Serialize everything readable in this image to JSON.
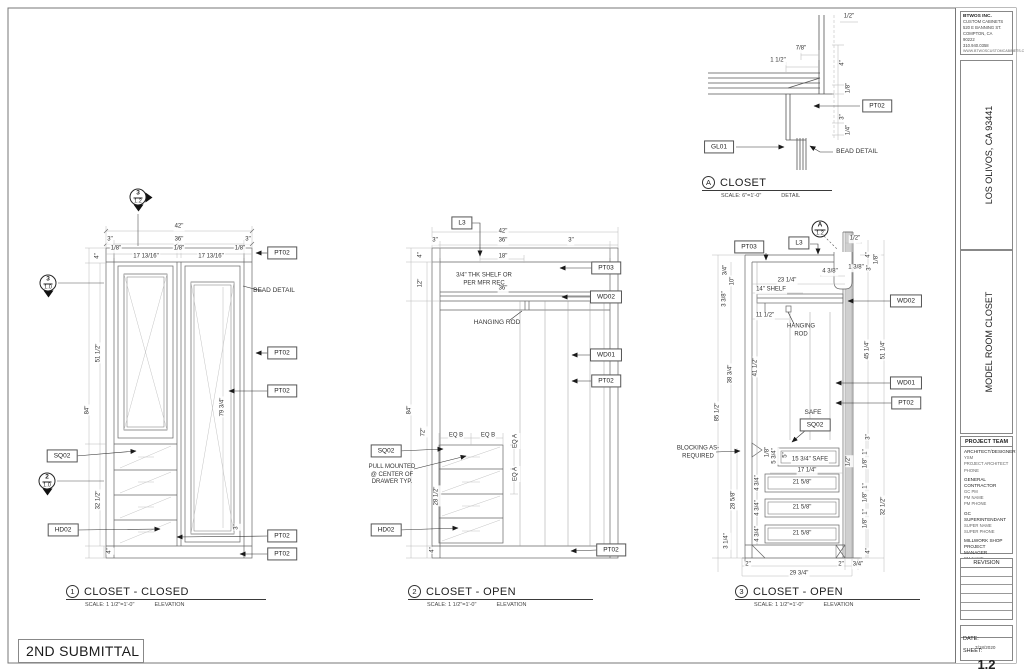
{
  "sheet": {
    "submittal": "2ND SUBMITTAL",
    "company": {
      "name": "BTWOS INC.",
      "lines": [
        "CUSTOM CABINETS",
        "520 E BANNING ST.",
        "COMPTON, CA",
        "90222",
        "310.940.0358",
        "WWW.BTWOSCUSTOMCABINETS.COM"
      ]
    },
    "project_location": {
      "label": "PROJECT LOCATION",
      "value": "LOS OLIVOS, CA 93441"
    },
    "room_or_area": {
      "label": "ROOM OR AREA",
      "value": "MODEL ROOM CLOSET"
    },
    "project_team": {
      "header": "PROJECT TEAM",
      "groups": [
        {
          "title": "ARCHITECT/DESIGNER",
          "lines": [
            "YSM",
            "PROJECT ARCHITECT",
            "PHONE"
          ]
        },
        {
          "title": "GENERAL CONTRACTOR",
          "lines": [
            "GC PM",
            "PM NAME",
            "PM PHONE"
          ]
        },
        {
          "title": "GC SUPERINTENDANT",
          "lines": [
            "SUPER NAME",
            "SUPER PHONE"
          ]
        },
        {
          "title": "MILLWORK SHOP PROJECT MANAGER",
          "lines": [
            "PM NAME",
            "PM PHONE"
          ]
        }
      ]
    },
    "revision": {
      "header": "REVISION"
    },
    "date": {
      "label": "DATE:",
      "value": "7/18/2020"
    },
    "sheet_number": {
      "label": "SHEET:",
      "value": "1.2"
    }
  },
  "viewport_titles": [
    {
      "num": "1",
      "title": "CLOSET - CLOSED",
      "scale": "SCALE: 1 1/2\"=1'-0\"",
      "type": "ELEVATION",
      "x": 66,
      "y": 585,
      "w": 200
    },
    {
      "num": "2",
      "title": "CLOSET - OPEN",
      "scale": "SCALE: 1 1/2\"=1'-0\"",
      "type": "ELEVATION",
      "x": 408,
      "y": 585,
      "w": 185
    },
    {
      "num": "3",
      "title": "CLOSET - OPEN",
      "scale": "SCALE: 1 1/2\"=1'-0\"",
      "type": "ELEVATION",
      "x": 735,
      "y": 585,
      "w": 185
    },
    {
      "num": "A",
      "title": "CLOSET",
      "scale": "SCALE: 6\"=1'-0\"",
      "type": "DETAIL",
      "x": 702,
      "y": 176,
      "w": 130
    }
  ],
  "section_markers": [
    {
      "top": "3",
      "bottom": "1.2",
      "x": 138,
      "y": 197,
      "tri": "down-right"
    },
    {
      "top": "3",
      "bottom": "1.0",
      "x": 48,
      "y": 283,
      "tri": "down"
    },
    {
      "top": "2",
      "bottom": "1.0",
      "x": 47,
      "y": 481,
      "tri": "down"
    },
    {
      "top": "A",
      "bottom": "1.2",
      "x": 820,
      "y": 229,
      "tri": "none"
    }
  ],
  "annotations": [
    {
      "t": "1/2\"",
      "x": 849,
      "y": 17
    },
    {
      "t": "7/8\"",
      "x": 801,
      "y": 49
    },
    {
      "t": "1 1/2\"",
      "x": 778,
      "y": 61
    },
    {
      "t": "4\"",
      "x": 843,
      "y": 63,
      "r": -90
    },
    {
      "t": "1/8\"",
      "x": 849,
      "y": 88,
      "r": -90
    },
    {
      "t": "PT02",
      "x": 877,
      "y": 106,
      "k": "tag",
      "n": "tag-pt02"
    },
    {
      "t": "3\"",
      "x": 843,
      "y": 117,
      "r": -90
    },
    {
      "t": "1/4\"",
      "x": 849,
      "y": 130,
      "r": -90
    },
    {
      "t": "GL01",
      "x": 719,
      "y": 147,
      "k": "tag",
      "n": "tag-gl01"
    },
    {
      "t": "BEAD DETAIL",
      "x": 857,
      "y": 152,
      "k": "label",
      "n": "bead-detail-label"
    },
    {
      "t": "42\"",
      "x": 179,
      "y": 227
    },
    {
      "t": "3\"",
      "x": 110,
      "y": 240
    },
    {
      "t": "36\"",
      "x": 179,
      "y": 240
    },
    {
      "t": "3\"",
      "x": 248,
      "y": 240
    },
    {
      "t": "1/8\"",
      "x": 116,
      "y": 249
    },
    {
      "t": "17 13/16\"",
      "x": 146,
      "y": 257
    },
    {
      "t": "1/8\"",
      "x": 179,
      "y": 249
    },
    {
      "t": "17 13/16\"",
      "x": 211,
      "y": 257
    },
    {
      "t": "1/8\"",
      "x": 240,
      "y": 249
    },
    {
      "t": "4\"",
      "x": 98,
      "y": 256,
      "r": -90
    },
    {
      "t": "PT02",
      "x": 282,
      "y": 253,
      "k": "tag",
      "n": "tag-pt02"
    },
    {
      "t": "BEAD DETAIL",
      "x": 274,
      "y": 291,
      "k": "label",
      "n": "bead-detail-label"
    },
    {
      "t": "51 1/2\"",
      "x": 99,
      "y": 353,
      "r": -90
    },
    {
      "t": "84\"",
      "x": 88,
      "y": 410,
      "r": -90
    },
    {
      "t": "PT02",
      "x": 282,
      "y": 353,
      "k": "tag",
      "n": "tag-pt02"
    },
    {
      "t": "PT02",
      "x": 282,
      "y": 391,
      "k": "tag",
      "n": "tag-pt02"
    },
    {
      "t": "79 3/4\"",
      "x": 223,
      "y": 407,
      "r": -90
    },
    {
      "t": "SQ02",
      "x": 62,
      "y": 456,
      "k": "tag",
      "n": "tag-sq02"
    },
    {
      "t": "32 1/2\"",
      "x": 99,
      "y": 500,
      "r": -90
    },
    {
      "t": "HD02",
      "x": 63,
      "y": 530,
      "k": "tag",
      "n": "tag-hd02"
    },
    {
      "t": "3\"",
      "x": 237,
      "y": 527,
      "r": -90
    },
    {
      "t": "PT02",
      "x": 282,
      "y": 536,
      "k": "tag",
      "n": "tag-pt02"
    },
    {
      "t": "4\"",
      "x": 110,
      "y": 551,
      "r": -90
    },
    {
      "t": "PT02",
      "x": 282,
      "y": 554,
      "k": "tag",
      "n": "tag-pt02"
    },
    {
      "t": "L3",
      "x": 462,
      "y": 223,
      "k": "tag",
      "n": "tag-l3"
    },
    {
      "t": "42\"",
      "x": 503,
      "y": 232
    },
    {
      "t": "3\"",
      "x": 435,
      "y": 241
    },
    {
      "t": "36\"",
      "x": 503,
      "y": 241
    },
    {
      "t": "3\"",
      "x": 571,
      "y": 241
    },
    {
      "t": "4\"",
      "x": 421,
      "y": 255,
      "r": -90
    },
    {
      "t": "18\"",
      "x": 503,
      "y": 257
    },
    {
      "t": "3/4\" THK SHELF OR\nPER MFR REC",
      "x": 484,
      "y": 280,
      "k": "note",
      "n": "shelf-note"
    },
    {
      "t": "PT03",
      "x": 606,
      "y": 268,
      "k": "tag",
      "n": "tag-pt03"
    },
    {
      "t": "36\"",
      "x": 503,
      "y": 289
    },
    {
      "t": "WD02",
      "x": 606,
      "y": 297,
      "k": "tag",
      "n": "tag-wd02"
    },
    {
      "t": "12\"",
      "x": 421,
      "y": 283,
      "r": -90
    },
    {
      "t": "HANGING ROD",
      "x": 497,
      "y": 323,
      "k": "label",
      "n": "hanging-rod-label"
    },
    {
      "t": "WD01",
      "x": 606,
      "y": 355,
      "k": "tag",
      "n": "tag-wd01"
    },
    {
      "t": "PT02",
      "x": 606,
      "y": 381,
      "k": "tag",
      "n": "tag-pt02"
    },
    {
      "t": "84\"",
      "x": 410,
      "y": 410,
      "r": -90
    },
    {
      "t": "72\"",
      "x": 424,
      "y": 432,
      "r": -90
    },
    {
      "t": "EQ B",
      "x": 456,
      "y": 436
    },
    {
      "t": "EQ B",
      "x": 488,
      "y": 436
    },
    {
      "t": "EQ A",
      "x": 516,
      "y": 441,
      "r": -90
    },
    {
      "t": "EQ A",
      "x": 516,
      "y": 474,
      "r": -90
    },
    {
      "t": "SQ02",
      "x": 386,
      "y": 451,
      "k": "tag",
      "n": "tag-sq02"
    },
    {
      "t": "PULL MOUNTED\n@ CENTER OF\nDRAWER TYP.",
      "x": 392,
      "y": 475,
      "k": "note",
      "n": "pull-note"
    },
    {
      "t": "28 1/2\"",
      "x": 437,
      "y": 496,
      "r": -90
    },
    {
      "t": "HD02",
      "x": 386,
      "y": 530,
      "k": "tag",
      "n": "tag-hd02"
    },
    {
      "t": "4\"",
      "x": 433,
      "y": 550,
      "r": -90
    },
    {
      "t": "PT02",
      "x": 611,
      "y": 550,
      "k": "tag",
      "n": "tag-pt02"
    },
    {
      "t": "PT03",
      "x": 749,
      "y": 247,
      "k": "tag",
      "n": "tag-pt03"
    },
    {
      "t": "L3",
      "x": 799,
      "y": 243,
      "k": "tag",
      "n": "tag-l3"
    },
    {
      "t": "1/2\"",
      "x": 855,
      "y": 239
    },
    {
      "t": "4\"",
      "x": 869,
      "y": 255,
      "r": -90
    },
    {
      "t": "1/8\"",
      "x": 877,
      "y": 259,
      "r": -90
    },
    {
      "t": "4 3/8\"",
      "x": 830,
      "y": 272
    },
    {
      "t": "1 3/8\"",
      "x": 856,
      "y": 268
    },
    {
      "t": "3\"",
      "x": 870,
      "y": 268,
      "r": -90
    },
    {
      "t": "3/4\"",
      "x": 726,
      "y": 270,
      "r": -90
    },
    {
      "t": "10\"",
      "x": 733,
      "y": 281,
      "r": -90
    },
    {
      "t": "23 1/4\"",
      "x": 787,
      "y": 281
    },
    {
      "t": "14\" SHELF",
      "x": 771,
      "y": 290
    },
    {
      "t": "3 3/8\"",
      "x": 725,
      "y": 299,
      "r": -90
    },
    {
      "t": "WD02",
      "x": 906,
      "y": 301,
      "k": "tag",
      "n": "tag-wd02"
    },
    {
      "t": "11 1/2\"",
      "x": 765,
      "y": 316
    },
    {
      "t": "HANGING\nROD",
      "x": 801,
      "y": 331,
      "k": "note",
      "n": "hanging-rod-label"
    },
    {
      "t": "45 1/4\"",
      "x": 868,
      "y": 350,
      "r": -90
    },
    {
      "t": "51 1/4\"",
      "x": 884,
      "y": 350,
      "r": -90
    },
    {
      "t": "41 1/2\"",
      "x": 756,
      "y": 367,
      "r": -90
    },
    {
      "t": "38 3/4\"",
      "x": 731,
      "y": 374,
      "r": -90
    },
    {
      "t": "WD01",
      "x": 906,
      "y": 383,
      "k": "tag",
      "n": "tag-wd01"
    },
    {
      "t": "PT02",
      "x": 906,
      "y": 403,
      "k": "tag",
      "n": "tag-pt02"
    },
    {
      "t": "85 1/2\"",
      "x": 718,
      "y": 412,
      "r": -90
    },
    {
      "t": "SAFE",
      "x": 813,
      "y": 413,
      "k": "label",
      "n": "safe-label"
    },
    {
      "t": "SQ02",
      "x": 815,
      "y": 425,
      "k": "tag",
      "n": "tag-sq02"
    },
    {
      "t": "BLOCKING AS-\nREQUIRED",
      "x": 698,
      "y": 453,
      "k": "note",
      "n": "blocking-note"
    },
    {
      "t": "1/8\"",
      "x": 768,
      "y": 452,
      "r": -90
    },
    {
      "t": "5 3/4\"",
      "x": 775,
      "y": 456,
      "r": -90
    },
    {
      "t": "5\"",
      "x": 786,
      "y": 455,
      "r": -90
    },
    {
      "t": "15 3/4\" SAFE",
      "x": 810,
      "y": 460
    },
    {
      "t": "1/2\"",
      "x": 849,
      "y": 461,
      "r": -90
    },
    {
      "t": "3\"",
      "x": 869,
      "y": 437,
      "r": -90
    },
    {
      "t": "17 1/4\"",
      "x": 807,
      "y": 471
    },
    {
      "t": "21 5/8\"",
      "x": 802,
      "y": 483
    },
    {
      "t": "4 3/4\"",
      "x": 758,
      "y": 483,
      "r": -90
    },
    {
      "t": "1\"",
      "x": 866,
      "y": 452,
      "r": -90
    },
    {
      "t": "1/8\"",
      "x": 866,
      "y": 463,
      "r": -90
    },
    {
      "t": "21 5/8\"",
      "x": 802,
      "y": 508
    },
    {
      "t": "4 3/4\"",
      "x": 758,
      "y": 508,
      "r": -90
    },
    {
      "t": "1\"",
      "x": 866,
      "y": 486,
      "r": -90
    },
    {
      "t": "1/8\"",
      "x": 866,
      "y": 497,
      "r": -90
    },
    {
      "t": "28 5/8\"",
      "x": 734,
      "y": 500,
      "r": -90
    },
    {
      "t": "32 1/2\"",
      "x": 884,
      "y": 506,
      "r": -90
    },
    {
      "t": "21 5/8\"",
      "x": 802,
      "y": 534
    },
    {
      "t": "4 3/4\"",
      "x": 758,
      "y": 534,
      "r": -90
    },
    {
      "t": "1\"",
      "x": 866,
      "y": 512,
      "r": -90
    },
    {
      "t": "1/8\"",
      "x": 866,
      "y": 523,
      "r": -90
    },
    {
      "t": "3 1/4\"",
      "x": 727,
      "y": 541,
      "r": -90
    },
    {
      "t": "4\"",
      "x": 869,
      "y": 551,
      "r": -90
    },
    {
      "t": "2\"",
      "x": 748,
      "y": 565
    },
    {
      "t": "2\"",
      "x": 841,
      "y": 565
    },
    {
      "t": "3/4\"",
      "x": 858,
      "y": 565
    },
    {
      "t": "29 3/4\"",
      "x": 799,
      "y": 574
    }
  ]
}
